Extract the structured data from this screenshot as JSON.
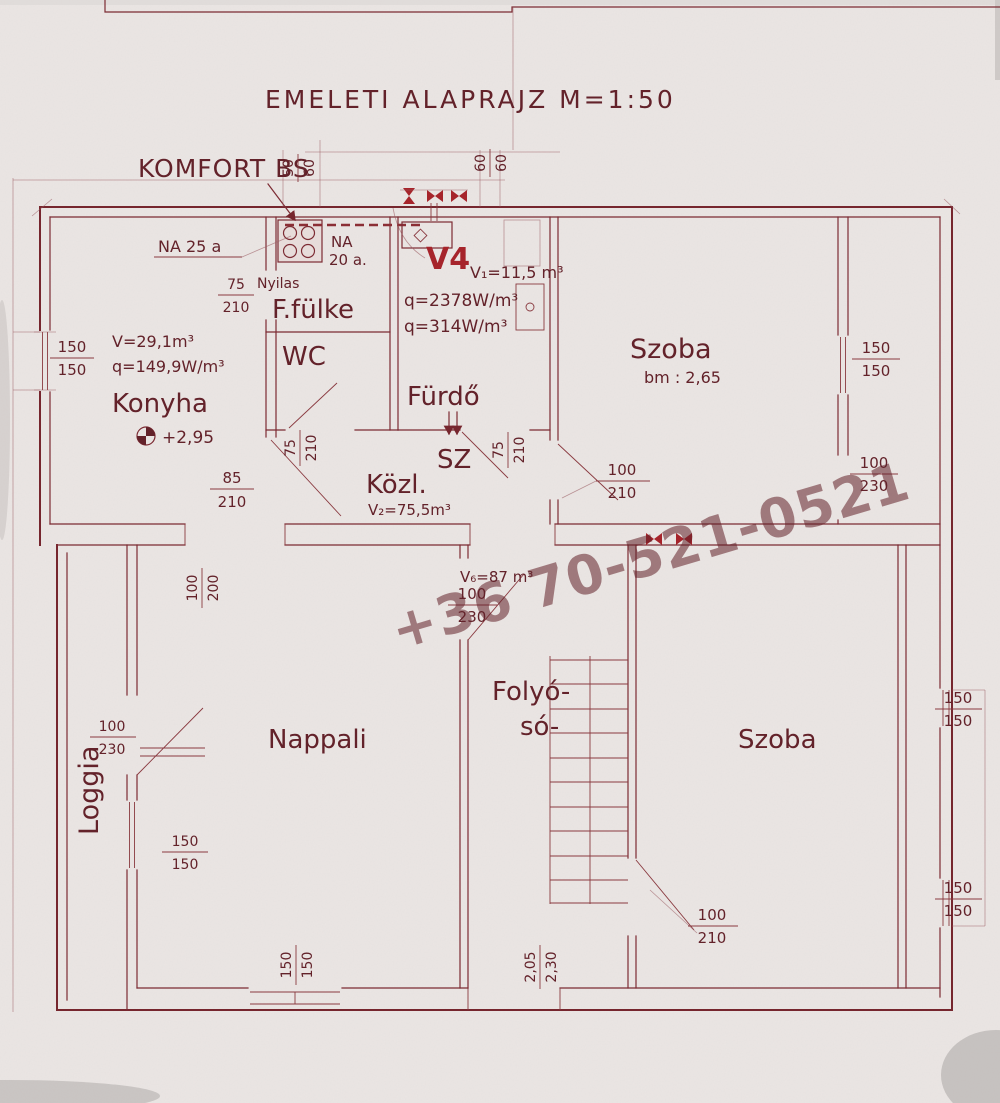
{
  "title": "EMELETI ALAPRAJZ M=1:50",
  "watermark": "+36 70-521-0521",
  "annotations": {
    "komfort": "KOMFORT BS",
    "na25": "NA 25 a",
    "na20_line1": "NA",
    "na20_line2": "20 a.",
    "v4": "V4",
    "v4_volume": "V₁=11,5 m³",
    "v4_q1": "q=2378W/m³",
    "v4_q2": "q=314W/m³",
    "nyilas": "Nyilas",
    "konyha_volume": "V=29,1m³",
    "konyha_q": "q=149,9W/m³",
    "level": "+2,95",
    "kozl_volume": "V₂=75,5m³",
    "szoba1_height": "bm : 2,65",
    "folyoso_volume": "V₆=87 m³"
  },
  "rooms": {
    "konyha": "Konyha",
    "ffulke": "F.fülke",
    "wc": "WC",
    "furdo": "Fürdő",
    "sz": "SZ",
    "kozl": "Közl.",
    "szoba1": "Szoba",
    "folyoso_line1": "Folyó-",
    "folyoso_line2": "só-",
    "nappali": "Nappali",
    "loggia": "Loggia",
    "szoba2": "Szoba"
  },
  "dimensions": {
    "win_konyha": {
      "w": "150",
      "h": "150"
    },
    "nyilas_door": {
      "w": "75",
      "h": "210"
    },
    "konyha_door": {
      "w": "85",
      "h": "210"
    },
    "wc_door": {
      "w": "75",
      "h": "210"
    },
    "sz_door": {
      "w": "75",
      "h": "210"
    },
    "szoba1_door": {
      "w": "100",
      "h": "210"
    },
    "szoba1_win": {
      "w": "150",
      "h": "150"
    },
    "szoba1_balcony": {
      "w": "100",
      "h": "230"
    },
    "folyoso_door": {
      "w": "100",
      "h": "230"
    },
    "nappali_top": {
      "w": "100",
      "h": "200"
    },
    "loggia_door": {
      "w": "100",
      "h": "230"
    },
    "loggia_win": {
      "w": "150",
      "h": "150"
    },
    "nappali_win": {
      "w": "150",
      "h": "150"
    },
    "terasz_door": {
      "w": "2,05",
      "h": "2,30"
    },
    "szoba2_door": {
      "w": "100",
      "h": "210"
    },
    "szoba2_win_top": {
      "w": "150",
      "h": "150"
    },
    "szoba2_win_bottom": {
      "w": "150",
      "h": "150"
    },
    "flue_left": {
      "w": "50",
      "h": "60"
    },
    "flue_right": {
      "w": "60",
      "h": "60"
    }
  }
}
